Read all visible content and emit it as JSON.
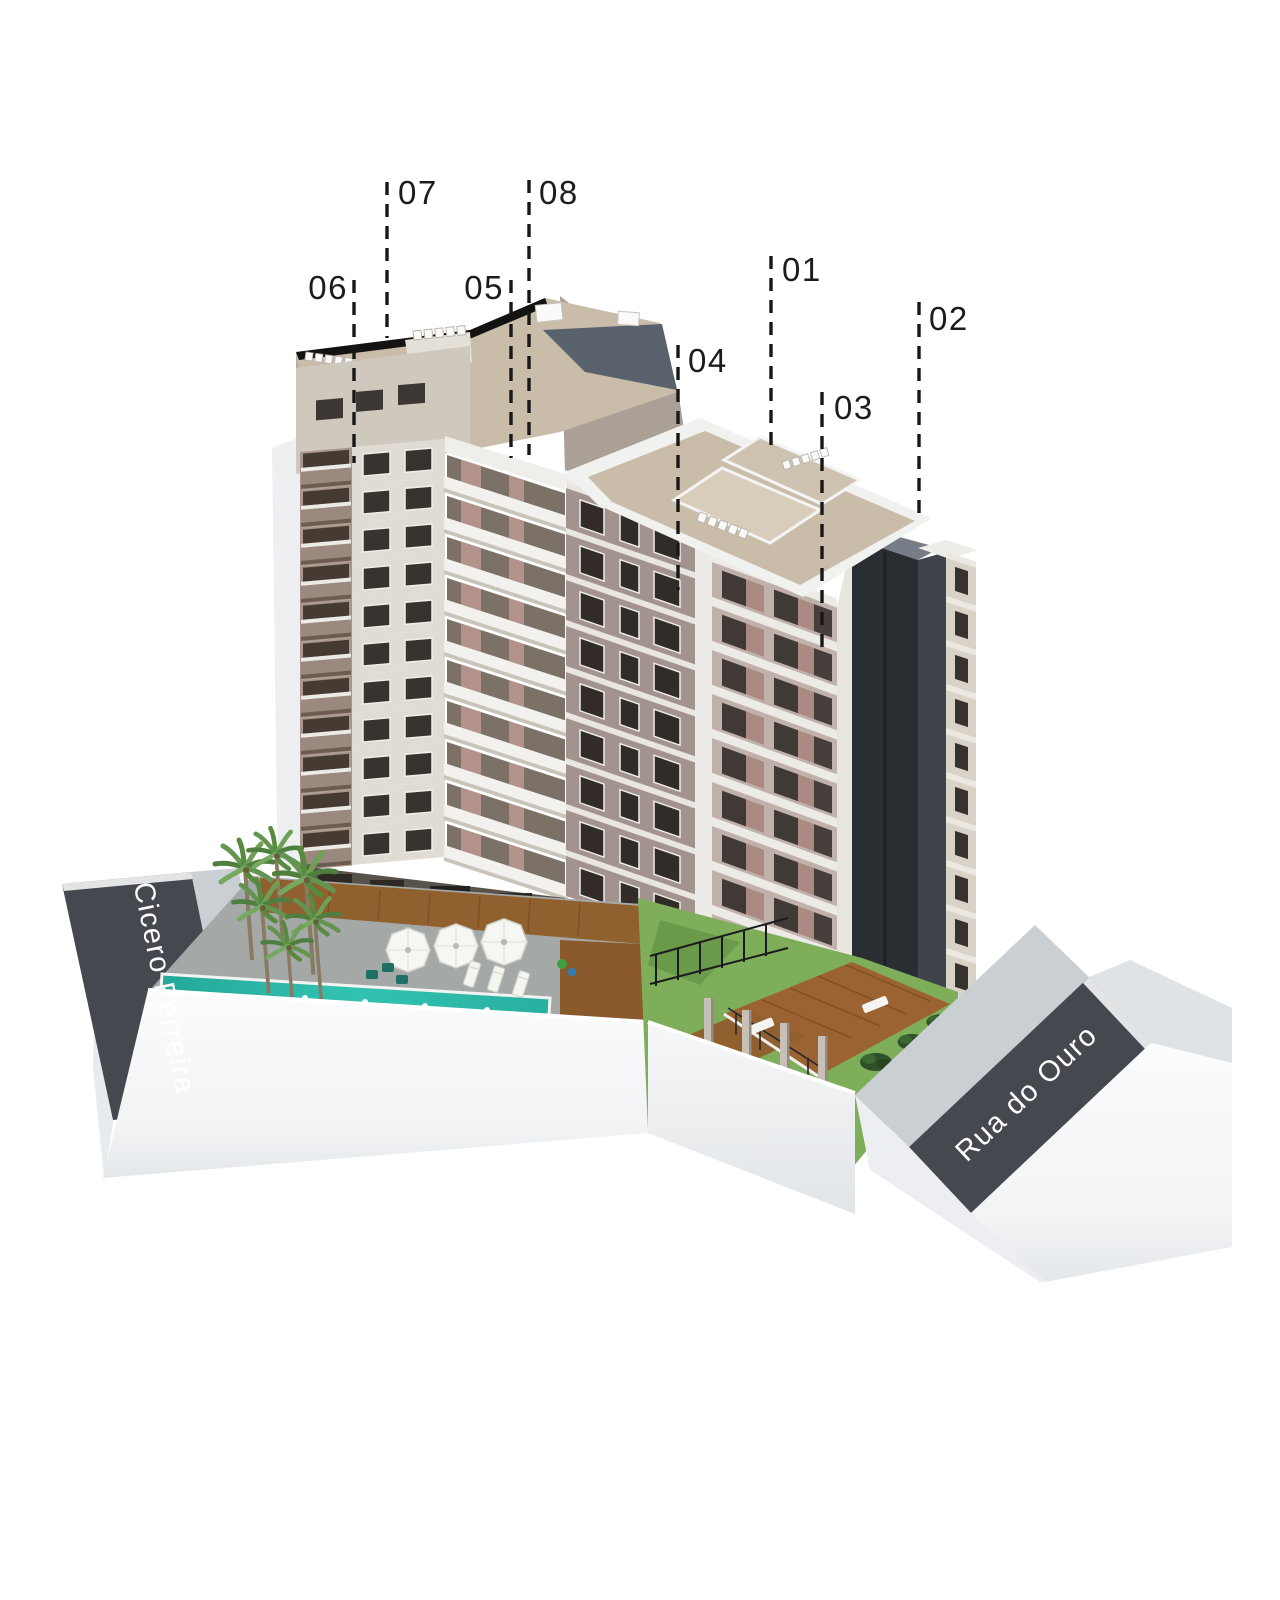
{
  "scene": {
    "description": "3D aerial rendering of a residential tower complex with numbered unit callouts and street name banners",
    "background": "#ffffff"
  },
  "callouts": {
    "units": [
      {
        "label": "01"
      },
      {
        "label": "02"
      },
      {
        "label": "03"
      },
      {
        "label": "04"
      },
      {
        "label": "05"
      },
      {
        "label": "06"
      },
      {
        "label": "07"
      },
      {
        "label": "08"
      }
    ]
  },
  "streets": {
    "left_label": "Cicero Ferreira",
    "right_label": "Rua do Ouro"
  },
  "palette": {
    "banner_charcoal": "#45494f",
    "street_text": "#ffffff",
    "label_text": "#1c1c1e",
    "facade_cream": "#e0dcd4",
    "facade_mauve": "#a2938e",
    "balcony_bronze": "#9b8a80",
    "roof_tan": "#c9bdaa",
    "roof_slate": "#58616c",
    "core_charcoal": "#2a2d32",
    "pool_teal": "#29b5a5",
    "grass_green": "#7fae5b",
    "deck_wood": "#91602f",
    "podium_white": "#f7f8f9",
    "sidewalk_gray": "#c9cfd3"
  }
}
